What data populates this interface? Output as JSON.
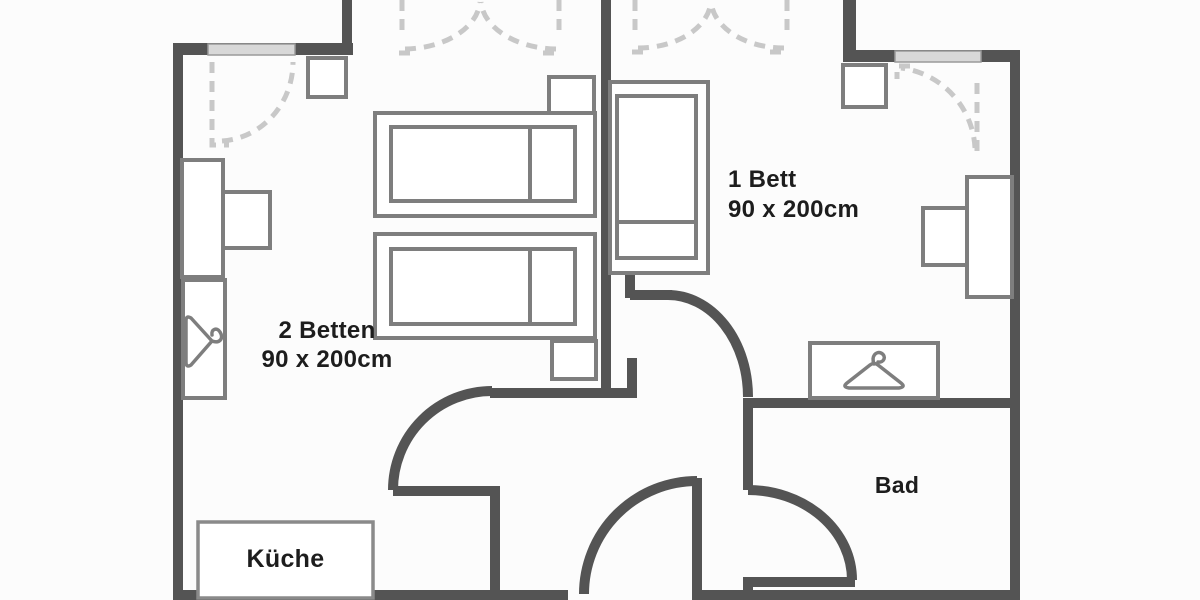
{
  "floorplan": {
    "type": "apartment-floor-plan",
    "labels": {
      "bedroom_left": {
        "line1": "2 Betten",
        "line2": "90 x 200cm"
      },
      "bedroom_right": {
        "line1": "1 Bett",
        "line2": "90 x 200cm"
      },
      "kitchen": "Küche",
      "bathroom": "Bad"
    },
    "rooms": [
      {
        "name": "bedroom-left",
        "beds": 2,
        "bed_size_cm": "90 x 200"
      },
      {
        "name": "bedroom-right",
        "beds": 1,
        "bed_size_cm": "90 x 200"
      },
      {
        "name": "kitchen"
      },
      {
        "name": "bathroom"
      },
      {
        "name": "hallway"
      }
    ],
    "furniture": [
      "double-single-bed-left-room-top",
      "single-bed-left-room-bottom",
      "single-bed-right-room",
      "nightstand-left-room-top",
      "nightstand-left-room-bottom",
      "nightstand-right-room",
      "corner-table-left-room",
      "desk-left-room",
      "chair-left-room",
      "wardrobe-left-room",
      "desk-right-room",
      "chair-right-room",
      "wardrobe-hall",
      "kitchen-unit"
    ],
    "icons": {
      "wardrobe_left": "coat-hanger-icon",
      "wardrobe_hall": "coat-hanger-icon"
    },
    "openings": {
      "windows": 2,
      "balcony_double_doors": 2,
      "swing_doors": [
        "bedroom-left-door",
        "bedroom-right-door",
        "bathroom-door",
        "entry-door"
      ]
    },
    "colors": {
      "wall": "#545454",
      "furniture_outline": "#7e7e7e",
      "dashed_swing": "#c8c8c8",
      "window_fill": "#d8d8d8",
      "background": "#fcfcfc",
      "text": "#1d1d1d"
    }
  }
}
